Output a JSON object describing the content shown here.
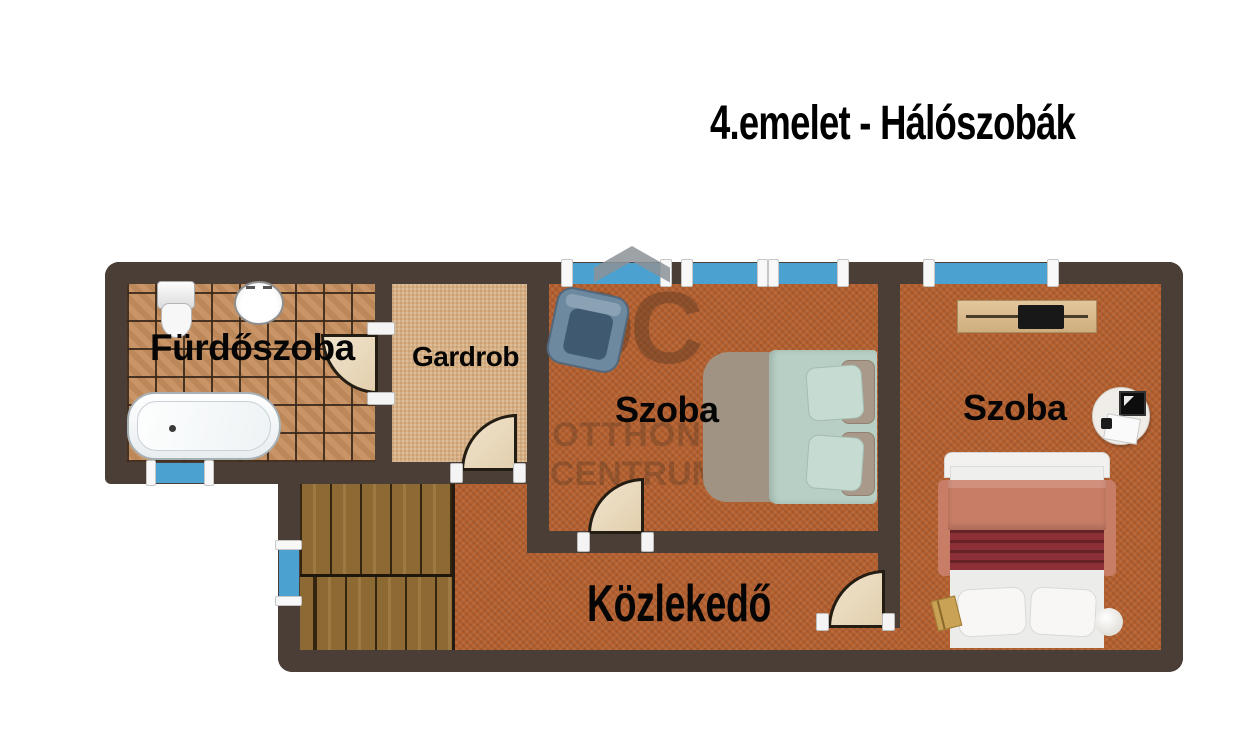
{
  "title": "4.emelet - Hálószobák",
  "floor_plan": {
    "rooms": [
      {
        "name": "bathroom",
        "label": "Fürdőszoba"
      },
      {
        "name": "wardrobe",
        "label": "Gardrob"
      },
      {
        "name": "bedroom-left",
        "label": "Szoba"
      },
      {
        "name": "bedroom-right",
        "label": "Szoba"
      },
      {
        "name": "hallway",
        "label": "Közlekedő"
      }
    ],
    "watermark": {
      "initials": "OC",
      "line1": "OTTHON",
      "line2": "CENTRUM"
    },
    "colors": {
      "wall": "#4a3e37",
      "window": "#4ba1cf",
      "carpet_orange": "#b5602f",
      "carpet_tan": "#d8b083",
      "tile": "#c78f5e",
      "stairs_wood": "#8d6a33",
      "door": "#eadcc1",
      "bed_green": "#b7cfc4",
      "bed_taupe": "#a09383",
      "blanket_maroon": "#8c2f36",
      "blanket_salmon": "#c87d66",
      "armchair": "#6d89a0"
    }
  }
}
